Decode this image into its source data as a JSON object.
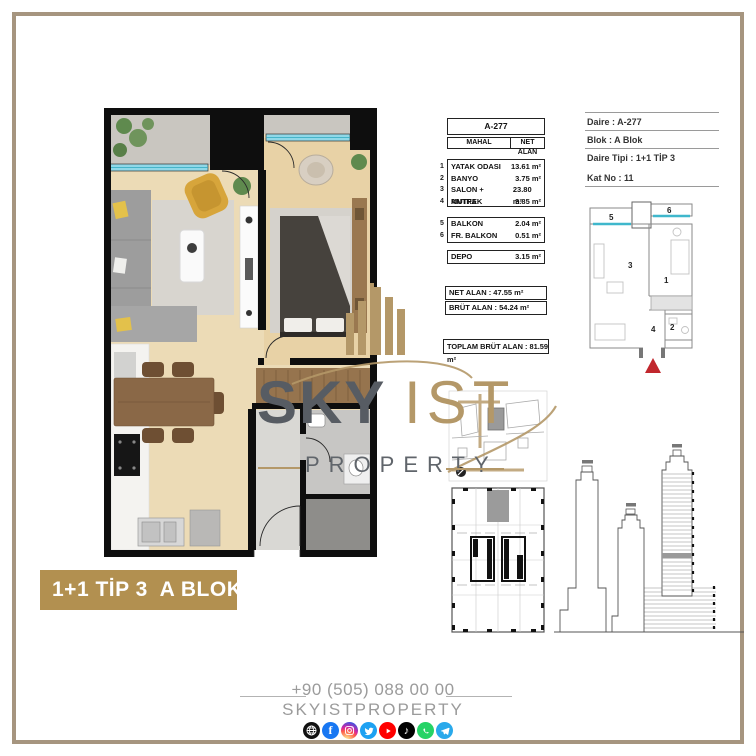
{
  "banner": {
    "label": "1+1 TİP 3  A BLOK"
  },
  "unit_table": {
    "unit_no": "A-277",
    "col_mahal": "MAHAL",
    "col_net_alan": "NET ALAN",
    "rooms": [
      {
        "no": "1",
        "name": "YATAK ODASI",
        "area": "13.61 m²"
      },
      {
        "no": "2",
        "name": "BANYO",
        "area": "3.75 m²"
      },
      {
        "no": "3",
        "name": "SALON + MUTFAK",
        "area": "23.80 m²"
      },
      {
        "no": "4",
        "name": "ANTRE",
        "area": "3.85 m²"
      }
    ],
    "balconies": [
      {
        "no": "5",
        "name": "BALKON",
        "area": "2.04 m²"
      },
      {
        "no": "6",
        "name": "FR. BALKON",
        "area": "0.51 m²"
      }
    ],
    "depo": {
      "name": "DEPO",
      "area": "3.15 m²"
    },
    "net_alan": "NET ALAN : 47.55 m²",
    "brut_alan": "BRÜT ALAN : 54.24 m²",
    "toplam_brut_alan": "TOPLAM BRÜT ALAN : 81.59 m²"
  },
  "unit_info": {
    "daire": "Daire : A-277",
    "blok": "Blok : A Blok",
    "daire_tipi": "Daire Tipi : 1+1 TİP 3",
    "kat_no": "Kat No : 11"
  },
  "key_plan": {
    "n1": "1",
    "n2": "2",
    "n3": "3",
    "n4": "4",
    "n5": "5",
    "n6": "6"
  },
  "logo": {
    "sky": "SKY",
    "ist": "IST",
    "property": "PROPERTY"
  },
  "footer": {
    "phone": "+90 (505) 088 00 00",
    "brand": "SKYISTPROPERTY",
    "social": [
      "website",
      "facebook",
      "instagram",
      "twitter",
      "youtube",
      "tiktok",
      "whatsapp",
      "telegram"
    ]
  },
  "colors": {
    "gold": "#b29050",
    "frame": "#a6957f",
    "logo_gold": "#b49868",
    "accent_red": "#c1272d",
    "window_teal": "#8fd8e8"
  }
}
